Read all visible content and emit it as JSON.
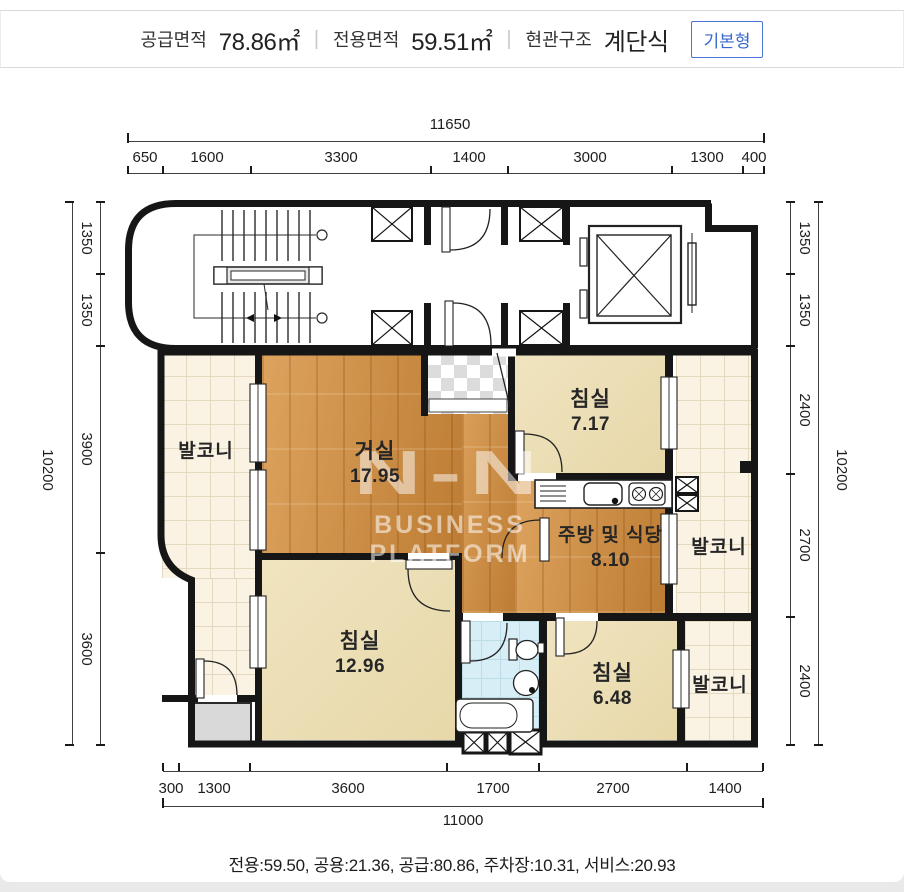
{
  "header": {
    "items": [
      {
        "label": "공급면적",
        "value": "78.86㎡"
      },
      {
        "label": "전용면적",
        "value": "59.51㎡"
      },
      {
        "label": "현관구조",
        "value": "계단식"
      }
    ],
    "divider": "|",
    "badge": "기본형"
  },
  "rooms": [
    {
      "name": "발코니",
      "area": ""
    },
    {
      "name": "거실",
      "area": "17.95"
    },
    {
      "name": "침실",
      "area": "7.17"
    },
    {
      "name": "주방 및 식당",
      "area": "8.10"
    },
    {
      "name": "발코니",
      "area": ""
    },
    {
      "name": "침실",
      "area": "12.96"
    },
    {
      "name": "침실",
      "area": "6.48"
    },
    {
      "name": "발코니",
      "area": ""
    }
  ],
  "dimensions": {
    "top": {
      "total": "11650",
      "segments": [
        "650",
        "1600",
        "3300",
        "1400",
        "3000",
        "1300",
        "400"
      ]
    },
    "bottom": {
      "total": "11000",
      "segments": [
        "300",
        "1300",
        "3600",
        "1700",
        "2700",
        "1400"
      ]
    },
    "left": {
      "total": "10200",
      "segments": [
        "1350",
        "1350",
        "3900",
        "3600"
      ]
    },
    "right": {
      "total": "10200",
      "segments": [
        "1350",
        "1350",
        "2400",
        "2700",
        "2400"
      ]
    }
  },
  "watermark": {
    "logo": "N-N",
    "label": "BUSINESS PLATFORM"
  },
  "footer": {
    "note": "전용:59.50, 공용:21.36, 공급:80.86, 주차장:10.31, 서비스:20.93"
  },
  "colors": {
    "wall": "#161616",
    "wood_floor": "#cd8c44",
    "bedroom_floor": "#ede0b8",
    "balcony_tile": "#faf3e3",
    "bathroom_tile": "#d8eef6",
    "accent_blue": "#3a67cc"
  }
}
